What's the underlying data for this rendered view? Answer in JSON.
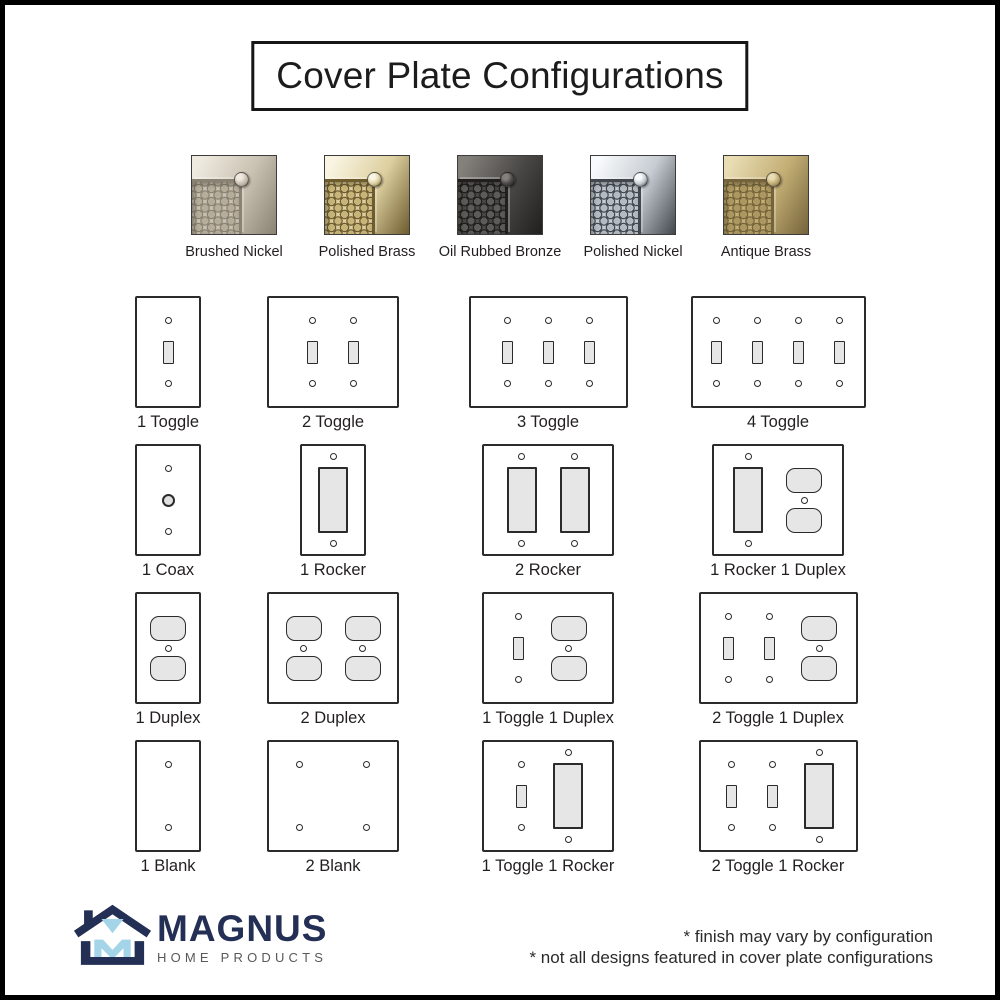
{
  "title": "Cover Plate Configurations",
  "finishes": [
    {
      "label": "Brushed Nickel",
      "colors": {
        "light": "#efeae0",
        "mid": "#c9c1b1",
        "dark": "#8a8272",
        "dot": "#b5ac9a"
      }
    },
    {
      "label": "Polished Brass",
      "colors": {
        "light": "#faf5e3",
        "mid": "#ddcf9f",
        "dark": "#6e5c2f",
        "dot": "#c6b478"
      }
    },
    {
      "label": "Oil Rubbed Bronze",
      "colors": {
        "light": "#84817c",
        "mid": "#4a4846",
        "dark": "#201f1e",
        "dot": "#5d5b58"
      }
    },
    {
      "label": "Polished Nickel",
      "colors": {
        "light": "#f8fafb",
        "mid": "#c6ccd2",
        "dark": "#42484e",
        "dot": "#b3bac1"
      }
    },
    {
      "label": "Antique Brass",
      "colors": {
        "light": "#e9ddb4",
        "mid": "#c3ae74",
        "dark": "#75643b",
        "dot": "#ac9760"
      }
    }
  ],
  "configurations": [
    {
      "label": "1 Toggle",
      "devices": [
        "toggle"
      ]
    },
    {
      "label": "2 Toggle",
      "devices": [
        "toggle",
        "toggle"
      ]
    },
    {
      "label": "3 Toggle",
      "devices": [
        "toggle",
        "toggle",
        "toggle"
      ]
    },
    {
      "label": "4 Toggle",
      "devices": [
        "toggle",
        "toggle",
        "toggle",
        "toggle"
      ]
    },
    {
      "label": "1 Coax",
      "devices": [
        "coax"
      ]
    },
    {
      "label": "1 Rocker",
      "devices": [
        "rocker"
      ]
    },
    {
      "label": "2 Rocker",
      "devices": [
        "rocker",
        "rocker"
      ]
    },
    {
      "label": "1 Rocker 1 Duplex",
      "devices": [
        "rocker",
        "duplex"
      ]
    },
    {
      "label": "1 Duplex",
      "devices": [
        "duplex"
      ]
    },
    {
      "label": "2 Duplex",
      "devices": [
        "duplex",
        "duplex"
      ]
    },
    {
      "label": "1 Toggle 1 Duplex",
      "devices": [
        "toggle",
        "duplex"
      ]
    },
    {
      "label": "2 Toggle 1 Duplex",
      "devices": [
        "toggle",
        "toggle",
        "duplex"
      ]
    },
    {
      "label": "1 Blank",
      "devices": [
        "blank"
      ]
    },
    {
      "label": "2 Blank",
      "devices": [
        "blank",
        "blank"
      ]
    },
    {
      "label": "1 Toggle 1 Rocker",
      "devices": [
        "toggle",
        "rocker"
      ]
    },
    {
      "label": "2 Toggle 1 Rocker",
      "devices": [
        "toggle",
        "toggle",
        "rocker"
      ]
    }
  ],
  "plate_style": {
    "stroke": "#2b2b2b",
    "opening_fill": "#e6e6e6"
  },
  "logo": {
    "name": "MAGNUS",
    "tagline": "HOME PRODUCTS",
    "navy": "#232f54",
    "blue": "#a3d4e8"
  },
  "footnotes": [
    "* finish may vary by configuration",
    "* not all designs featured in cover plate configurations"
  ]
}
